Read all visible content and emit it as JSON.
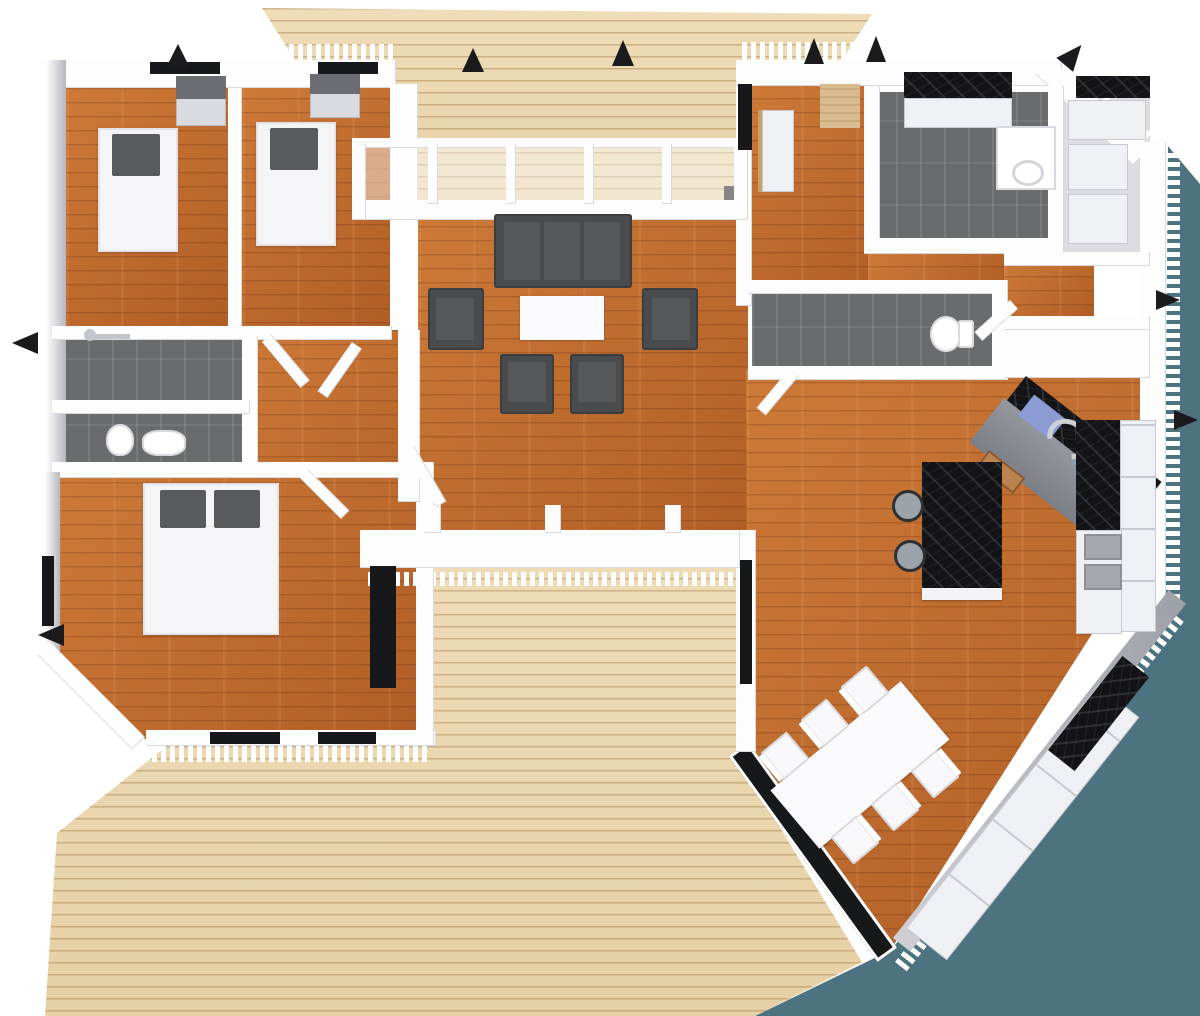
{
  "meta": {
    "type": "3d-floor-plan-render",
    "view": "bird's-eye cutaway",
    "width_px": 1200,
    "height_px": 1016,
    "visible_text": "none"
  },
  "palette": {
    "bg": "#ffffff",
    "ground": "#4e7380",
    "deck-light": "#efddb9",
    "deck-dark": "#e6d0a5",
    "wood-hi": "#cd7a38",
    "wood-lo": "#b05d26",
    "tile": "#696b6d",
    "wall": "#fdfdfe",
    "glass": "#17181b",
    "sofa": "#4a4b4d",
    "pillow": "#595a5e",
    "marble": "#141417",
    "mat-blue": "#8b9bd4"
  },
  "outdoor": {
    "ground_plane": "teal polygon, lower right",
    "upper_deck": "pale pine deck, top center",
    "lower_deck": "pale pine deck, bottom left",
    "roof_fragments": "small black eave triangles at wall corners",
    "wall_tops": "white zig-zag sawtooth cut edges"
  },
  "rooms": [
    {
      "name": "bedroom-1",
      "floor": "wood",
      "contents": [
        "single-bed",
        "pillow",
        "wardrobe"
      ]
    },
    {
      "name": "bedroom-2",
      "floor": "wood",
      "contents": [
        "single-bed",
        "pillow",
        "wardrobe"
      ]
    },
    {
      "name": "shower-room",
      "floor": "gray-tile",
      "contents": [
        "shower-fixture"
      ]
    },
    {
      "name": "wc",
      "floor": "gray-tile",
      "contents": [
        "toilet",
        "sink"
      ]
    },
    {
      "name": "hallway",
      "floor": "wood",
      "contents": [
        "open-doors"
      ]
    },
    {
      "name": "master-bedroom",
      "floor": "wood",
      "contents": [
        "double-bed",
        "two-pillows"
      ]
    },
    {
      "name": "living-room",
      "floor": "wood",
      "contents": [
        "sofa",
        "armchairs-4",
        "coffee-table"
      ]
    },
    {
      "name": "entry-hall",
      "floor": "wood",
      "contents": [
        "door-mat",
        "shelf",
        "entry-door"
      ]
    },
    {
      "name": "utility-room",
      "floor": "gray-tile",
      "contents": [
        "counter-black-top",
        "water-heater"
      ]
    },
    {
      "name": "bathroom-2",
      "floor": "gray-tile",
      "contents": [
        "toilet"
      ]
    },
    {
      "name": "storage-room",
      "floor": "light-gray",
      "contents": [
        "shelving",
        "black-counter"
      ]
    },
    {
      "name": "kitchen",
      "floor": "wood",
      "contents": [
        "corner-sink",
        "faucet",
        "blue-mats",
        "island-black-marble",
        "bar-stools-2",
        "counter-run",
        "appliances"
      ]
    },
    {
      "name": "dining-area",
      "floor": "wood",
      "contents": [
        "dining-table",
        "chairs-6",
        "diagonal-window-wall"
      ]
    }
  ],
  "furniture_colors": {
    "sofa_set": "dark gray",
    "beds": "white with dark gray pillows",
    "tables": "white",
    "kitchen_counters": "black marble on white cabinets",
    "bar_stools": "gray with black legs"
  }
}
